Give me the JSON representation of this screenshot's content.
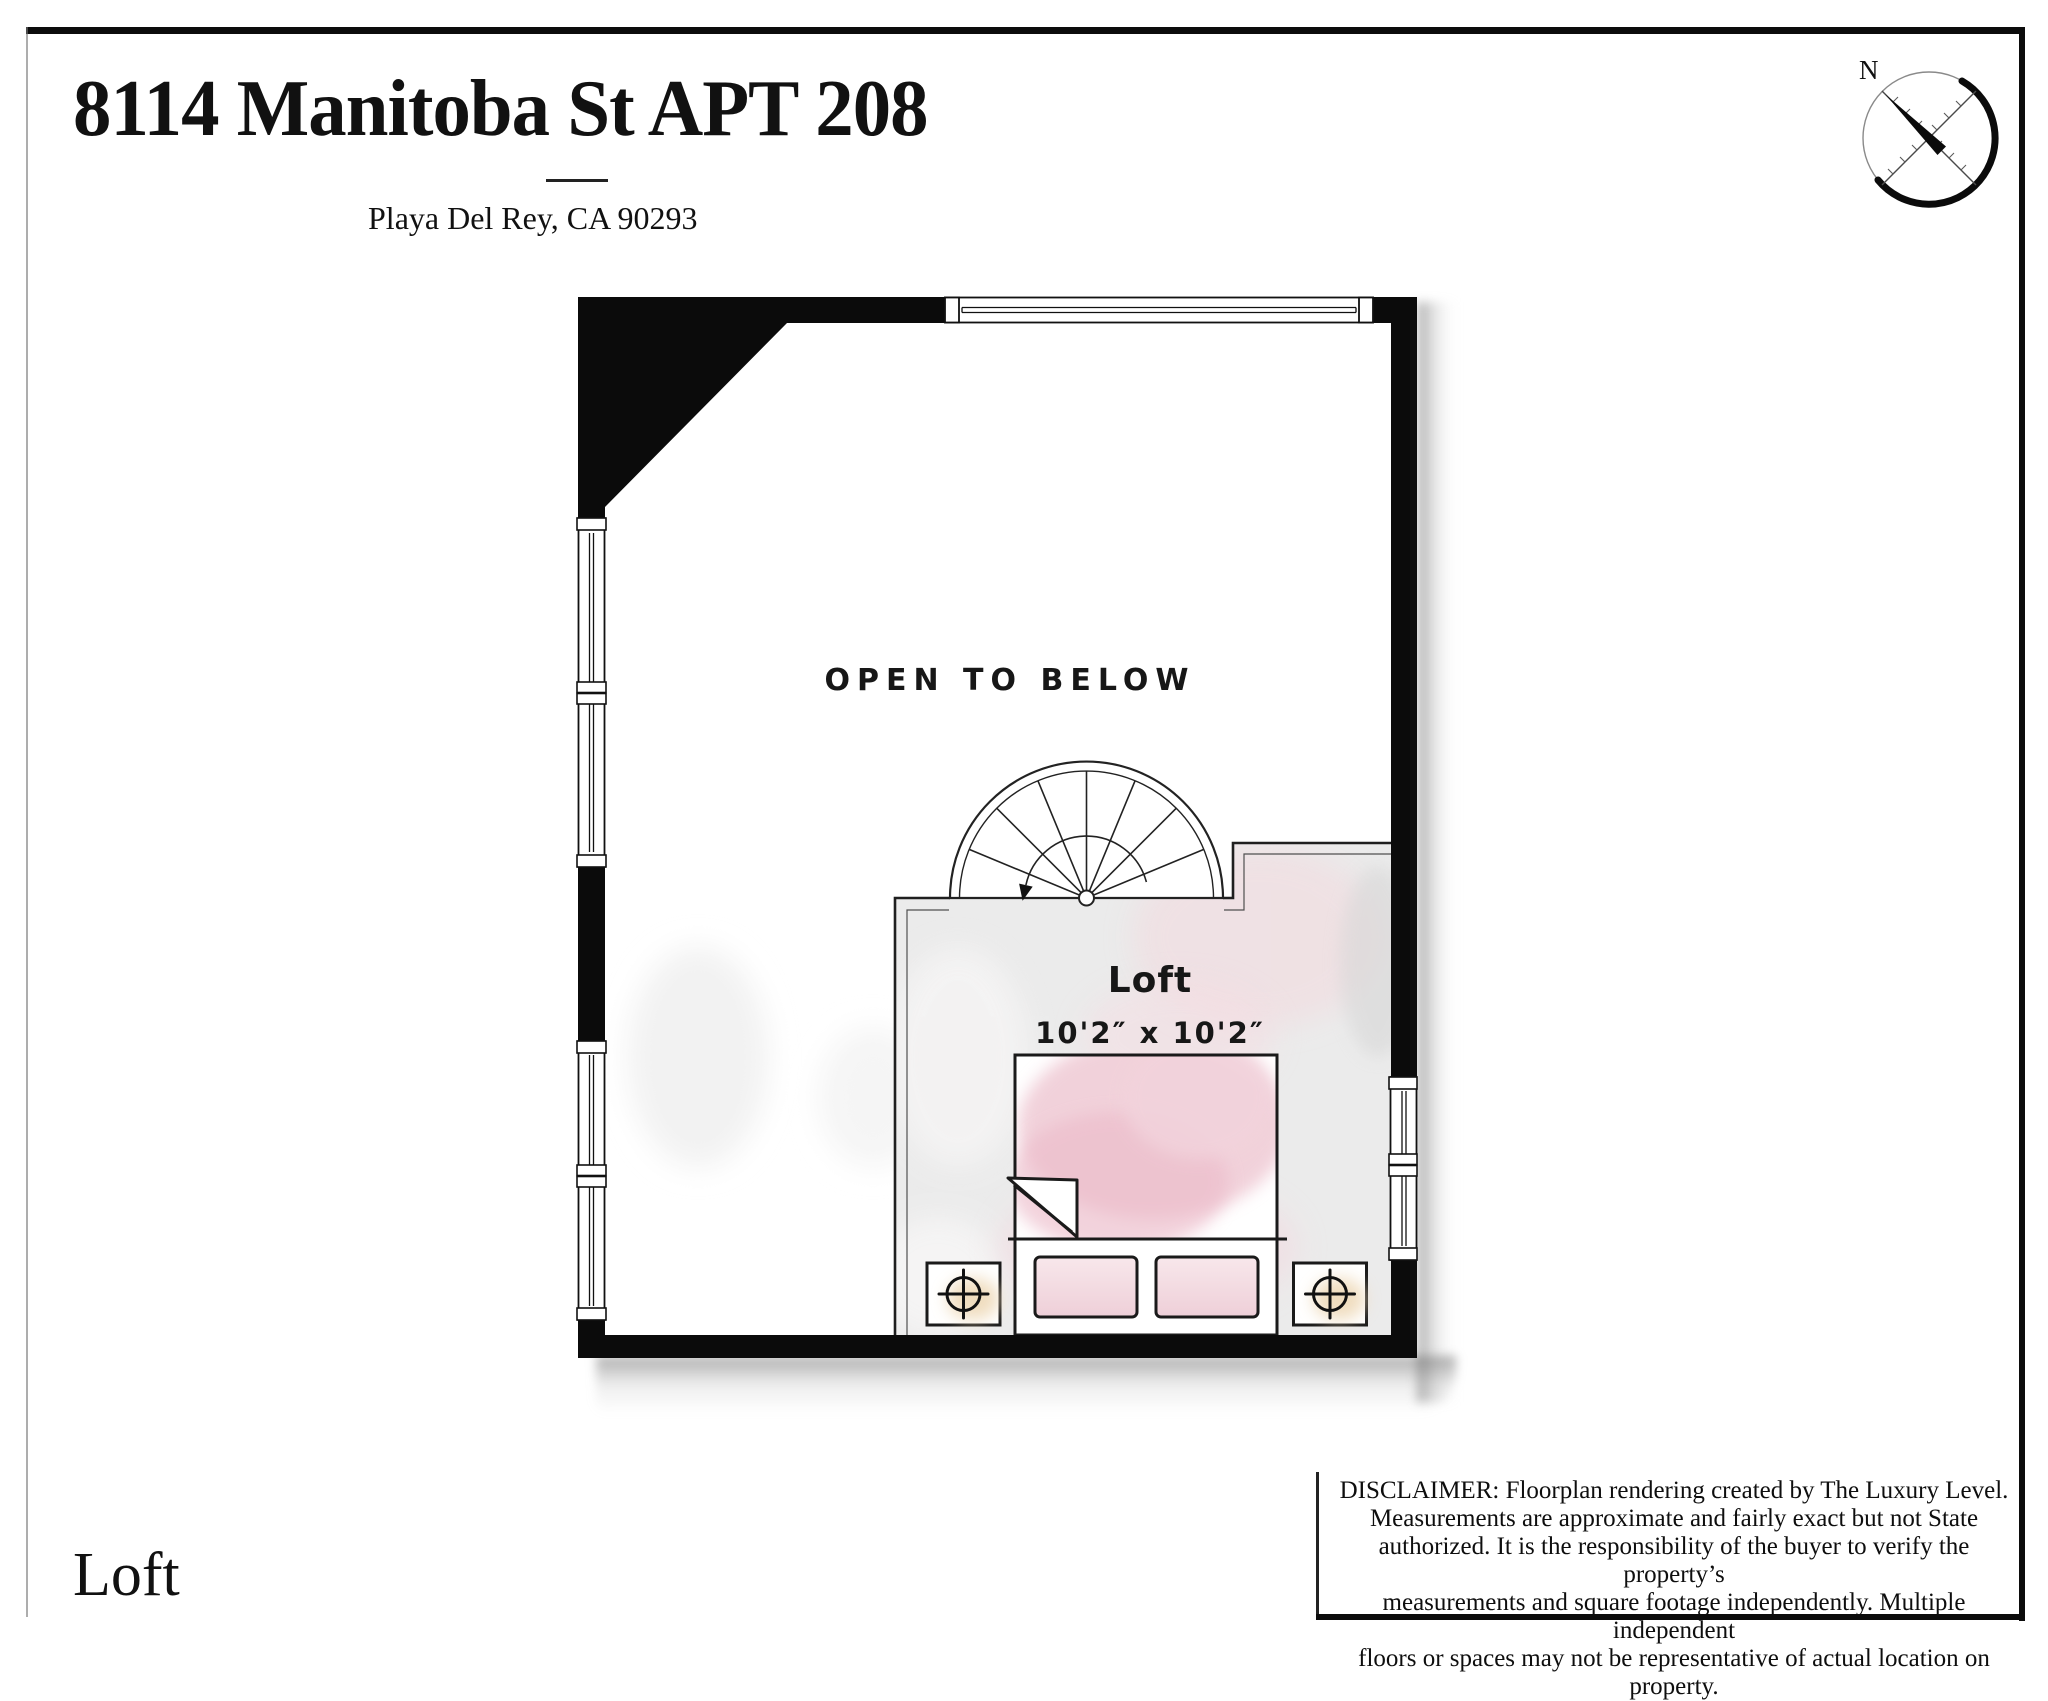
{
  "header": {
    "title": "8114 Manitoba St APT 208",
    "subtitle": "Playa Del Rey, CA 90293",
    "compass_label": "N"
  },
  "plan": {
    "open_area_label": "OPEN TO BELOW",
    "room": {
      "name": "Loft",
      "dimensions": "10'2″ x 10'2″"
    }
  },
  "footer": {
    "floor_label": "Loft"
  },
  "disclaimer": {
    "lines": [
      "DISCLAIMER: Floorplan rendering created by The Luxury Level.",
      "Measurements are approximate and fairly exact but not State",
      "authorized. It is the responsibility of the buyer to verify the property’s",
      "measurements and square footage independently. Multiple independent",
      "floors or spaces may not be representative of actual location on property."
    ]
  },
  "colors": {
    "wall_black": "#0b0b0b",
    "floor_gray": "#ebebeb",
    "duvet_pink": "#eec6d1",
    "lamp_wood_tan": "#eed9b8",
    "line_ink": "#1a1a1a"
  }
}
